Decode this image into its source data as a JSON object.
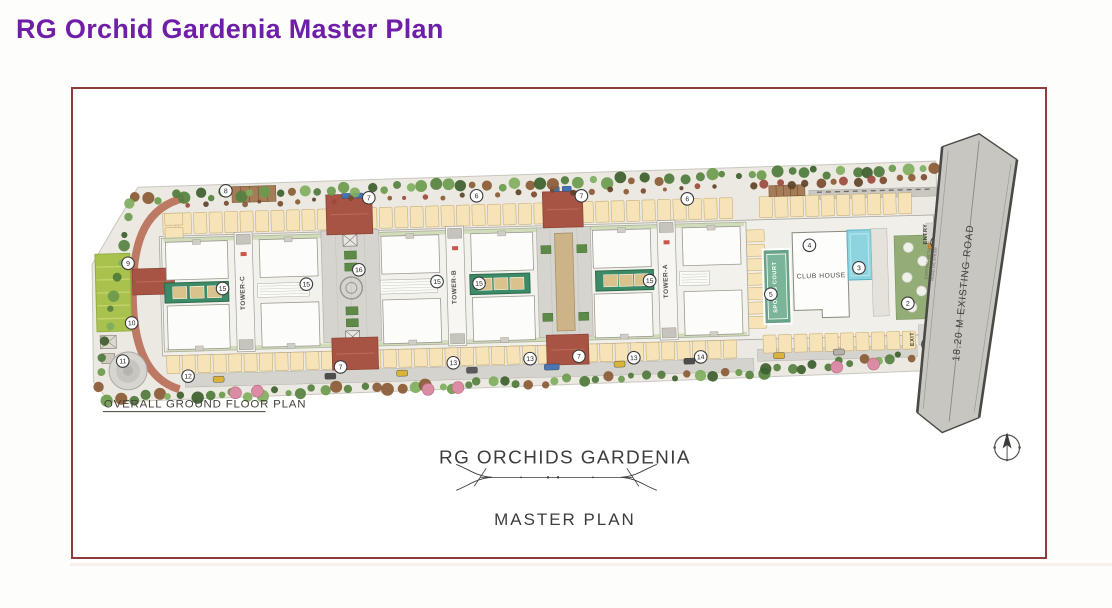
{
  "page": {
    "heading": "RG Orchid Gardenia Master Plan"
  },
  "plan": {
    "caption": "OVERALL GROUND FLOOR PLAN",
    "title": "RG ORCHIDS GARDENIA",
    "subtitle": "MASTER PLAN",
    "towers": [
      {
        "label": "TOWER-C",
        "x": 172
      },
      {
        "label": "TOWER-B",
        "x": 384
      },
      {
        "label": "TOWER-A",
        "x": 596
      }
    ],
    "labels": {
      "club_house": "CLUB HOUSE",
      "sports_court": "SPORTS COURT",
      "entry": "ENTRY",
      "exit": "EXIT",
      "road": "18.20 M EXISTING ROAD",
      "road_note_line1": "EXISTING METALLIC",
      "road_note_line2": "ROAD LVL 978.5M"
    },
    "markers": [
      {
        "n": "1",
        "x": 867,
        "y": 166
      },
      {
        "n": "1",
        "x": 855,
        "y": 268
      },
      {
        "n": "2",
        "x": 836,
        "y": 226
      },
      {
        "n": "3",
        "x": 788,
        "y": 189
      },
      {
        "n": "4",
        "x": 739,
        "y": 165
      },
      {
        "n": "5",
        "x": 699,
        "y": 213
      },
      {
        "n": "6",
        "x": 407,
        "y": 106
      },
      {
        "n": "6",
        "x": 618,
        "y": 115
      },
      {
        "n": "7",
        "x": 299,
        "y": 105
      },
      {
        "n": "7",
        "x": 512,
        "y": 109
      },
      {
        "n": "7",
        "x": 266,
        "y": 274
      },
      {
        "n": "7",
        "x": 505,
        "y": 270
      },
      {
        "n": "8",
        "x": 156,
        "y": 94
      },
      {
        "n": "9",
        "x": 56,
        "y": 164
      },
      {
        "n": "10",
        "x": 58,
        "y": 224
      },
      {
        "n": "11",
        "x": 48,
        "y": 262
      },
      {
        "n": "12",
        "x": 113,
        "y": 279
      },
      {
        "n": "13",
        "x": 379,
        "y": 273
      },
      {
        "n": "13",
        "x": 456,
        "y": 271
      },
      {
        "n": "13",
        "x": 560,
        "y": 273
      },
      {
        "n": "14",
        "x": 627,
        "y": 274
      },
      {
        "n": "15",
        "x": 150,
        "y": 192
      },
      {
        "n": "15",
        "x": 234,
        "y": 190
      },
      {
        "n": "15",
        "x": 365,
        "y": 191
      },
      {
        "n": "15",
        "x": 407,
        "y": 194
      },
      {
        "n": "16",
        "x": 287,
        "y": 177
      },
      {
        "n": "15",
        "x": 578,
        "y": 196
      }
    ],
    "colors": {
      "accent_purple": "#6f1fa7",
      "frame_border": "#8e3b3b",
      "brick": "#a85444",
      "teal_block": "#3c8a66",
      "pool": "#8ed4e0",
      "lawn": "#a9c14d",
      "court": "#69a287",
      "parking_stall": "#f6e4b8",
      "road": "#c8c6c1"
    }
  }
}
